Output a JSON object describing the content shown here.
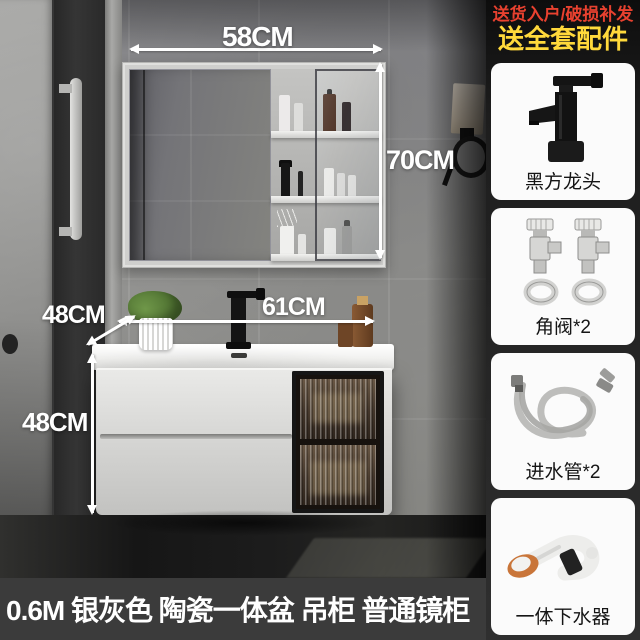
{
  "scene": {
    "dimensions": {
      "mirror_width": "58CM",
      "mirror_height": "70CM",
      "basin_width": "61CM",
      "counter_depth": "48CM",
      "cabinet_height": "48CM"
    }
  },
  "sidebar": {
    "promo_line1": "送货入户/破损补发",
    "promo_line2": "送全套配件",
    "cards": [
      {
        "label": "黑方龙头",
        "icon": "black-square-faucet-icon"
      },
      {
        "label": "角阀*2",
        "icon": "angle-valves-icon"
      },
      {
        "label": "进水管*2",
        "icon": "water-inlet-hoses-icon"
      },
      {
        "label": "一体下水器",
        "icon": "integrated-drain-icon"
      }
    ]
  },
  "banner": {
    "caption": "0.6M 银灰色 陶瓷一体盆 吊柜 普通镜柜"
  },
  "colors": {
    "promo_red": "#e8412f",
    "promo_yellow": "#ffd93b",
    "banner_bg": "#3b3b3b",
    "banner_text": "#ffffff",
    "dimension_text": "#ffffff",
    "sidebar_bg": "#1c1c1c",
    "card_bg": "#fbfbfb",
    "card_label": "#151515"
  }
}
